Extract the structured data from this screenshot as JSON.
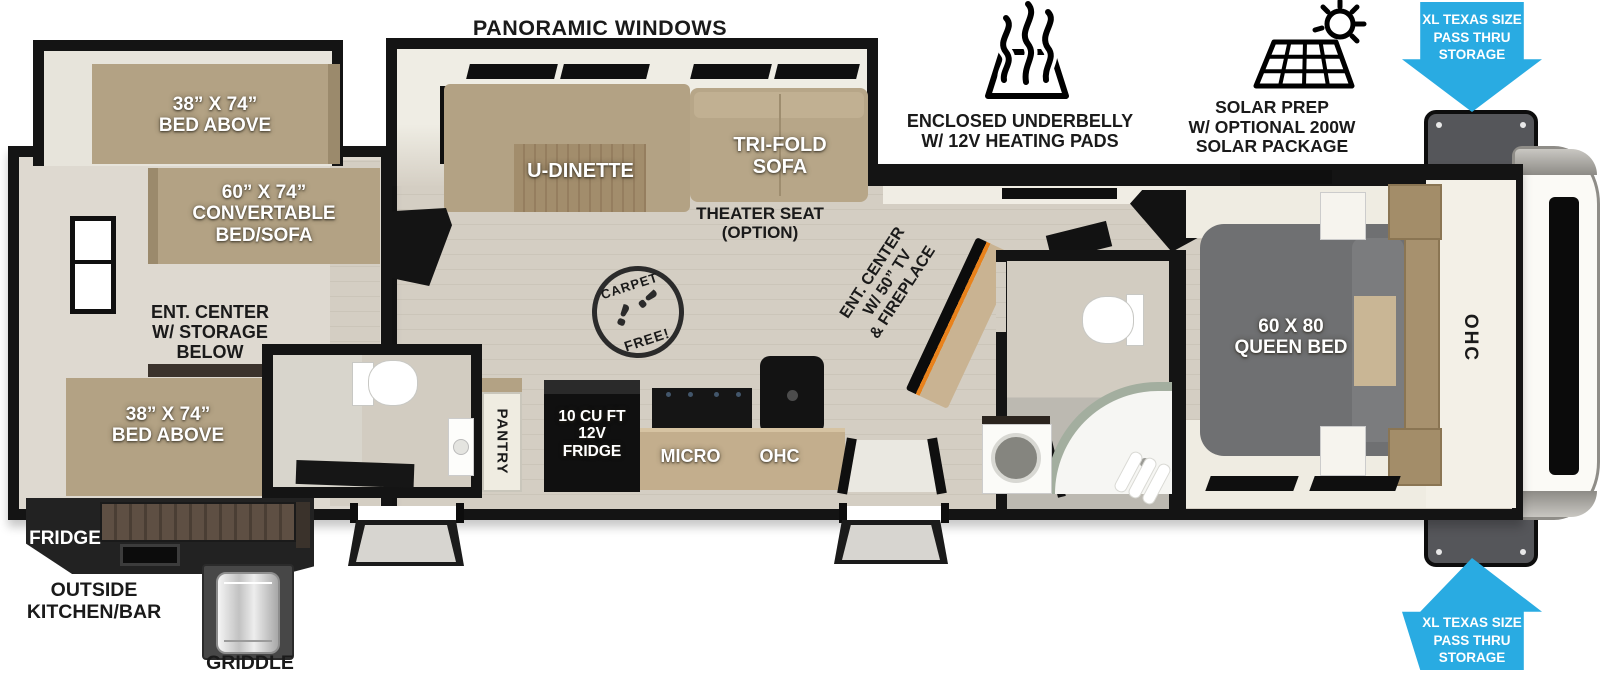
{
  "annotations": {
    "panoramic_windows": "PANORAMIC WINDOWS",
    "enclosed_underbelly": "ENCLOSED UNDERBELLY\nW/ 12V HEATING PADS",
    "solar_prep": "SOLAR PREP\nW/ OPTIONAL 200W\nSOLAR PACKAGE",
    "pass_thru_storage_top": "XL TEXAS SIZE\nPASS THRU\nSTORAGE",
    "pass_thru_storage_bottom": "XL TEXAS SIZE\nPASS THRU\nSTORAGE",
    "carpet_free": {
      "top": "CARPET",
      "bottom": "FREE!"
    }
  },
  "bunk_room": {
    "bed_above_top": "38” X 74”\nBED ABOVE",
    "convertible_bed": "60” X 74”\nCONVERTABLE\nBED/SOFA",
    "ent_center": "ENT. CENTER\nW/ STORAGE\nBELOW",
    "bed_above_bottom": "38” X 74”\nBED ABOVE"
  },
  "living_area": {
    "u_dinette": "U-DINETTE",
    "tri_fold_sofa": "TRI-FOLD\nSOFA",
    "theater_seat": "THEATER SEAT\n(OPTION)",
    "ent_center_tv": "ENT. CENTER\nW/ 50” TV\n& FIREPLACE"
  },
  "kitchen": {
    "pantry": "PANTRY",
    "fridge": "10 CU FT\n12V\nFRIDGE",
    "micro": "MICRO",
    "ohc": "OHC"
  },
  "front_bedroom": {
    "queen_bed": "60 X 80\nQUEEN BED",
    "ohc": "OHC"
  },
  "outside_kitchen": {
    "fridge": "FRIDGE",
    "kitchen_bar": "OUTSIDE\nKITCHEN/BAR",
    "griddle": "GRIDDLE"
  },
  "colors": {
    "accent_blue": "#29abe2",
    "furniture_tan": "#b3a284",
    "wall_black": "#141414"
  }
}
